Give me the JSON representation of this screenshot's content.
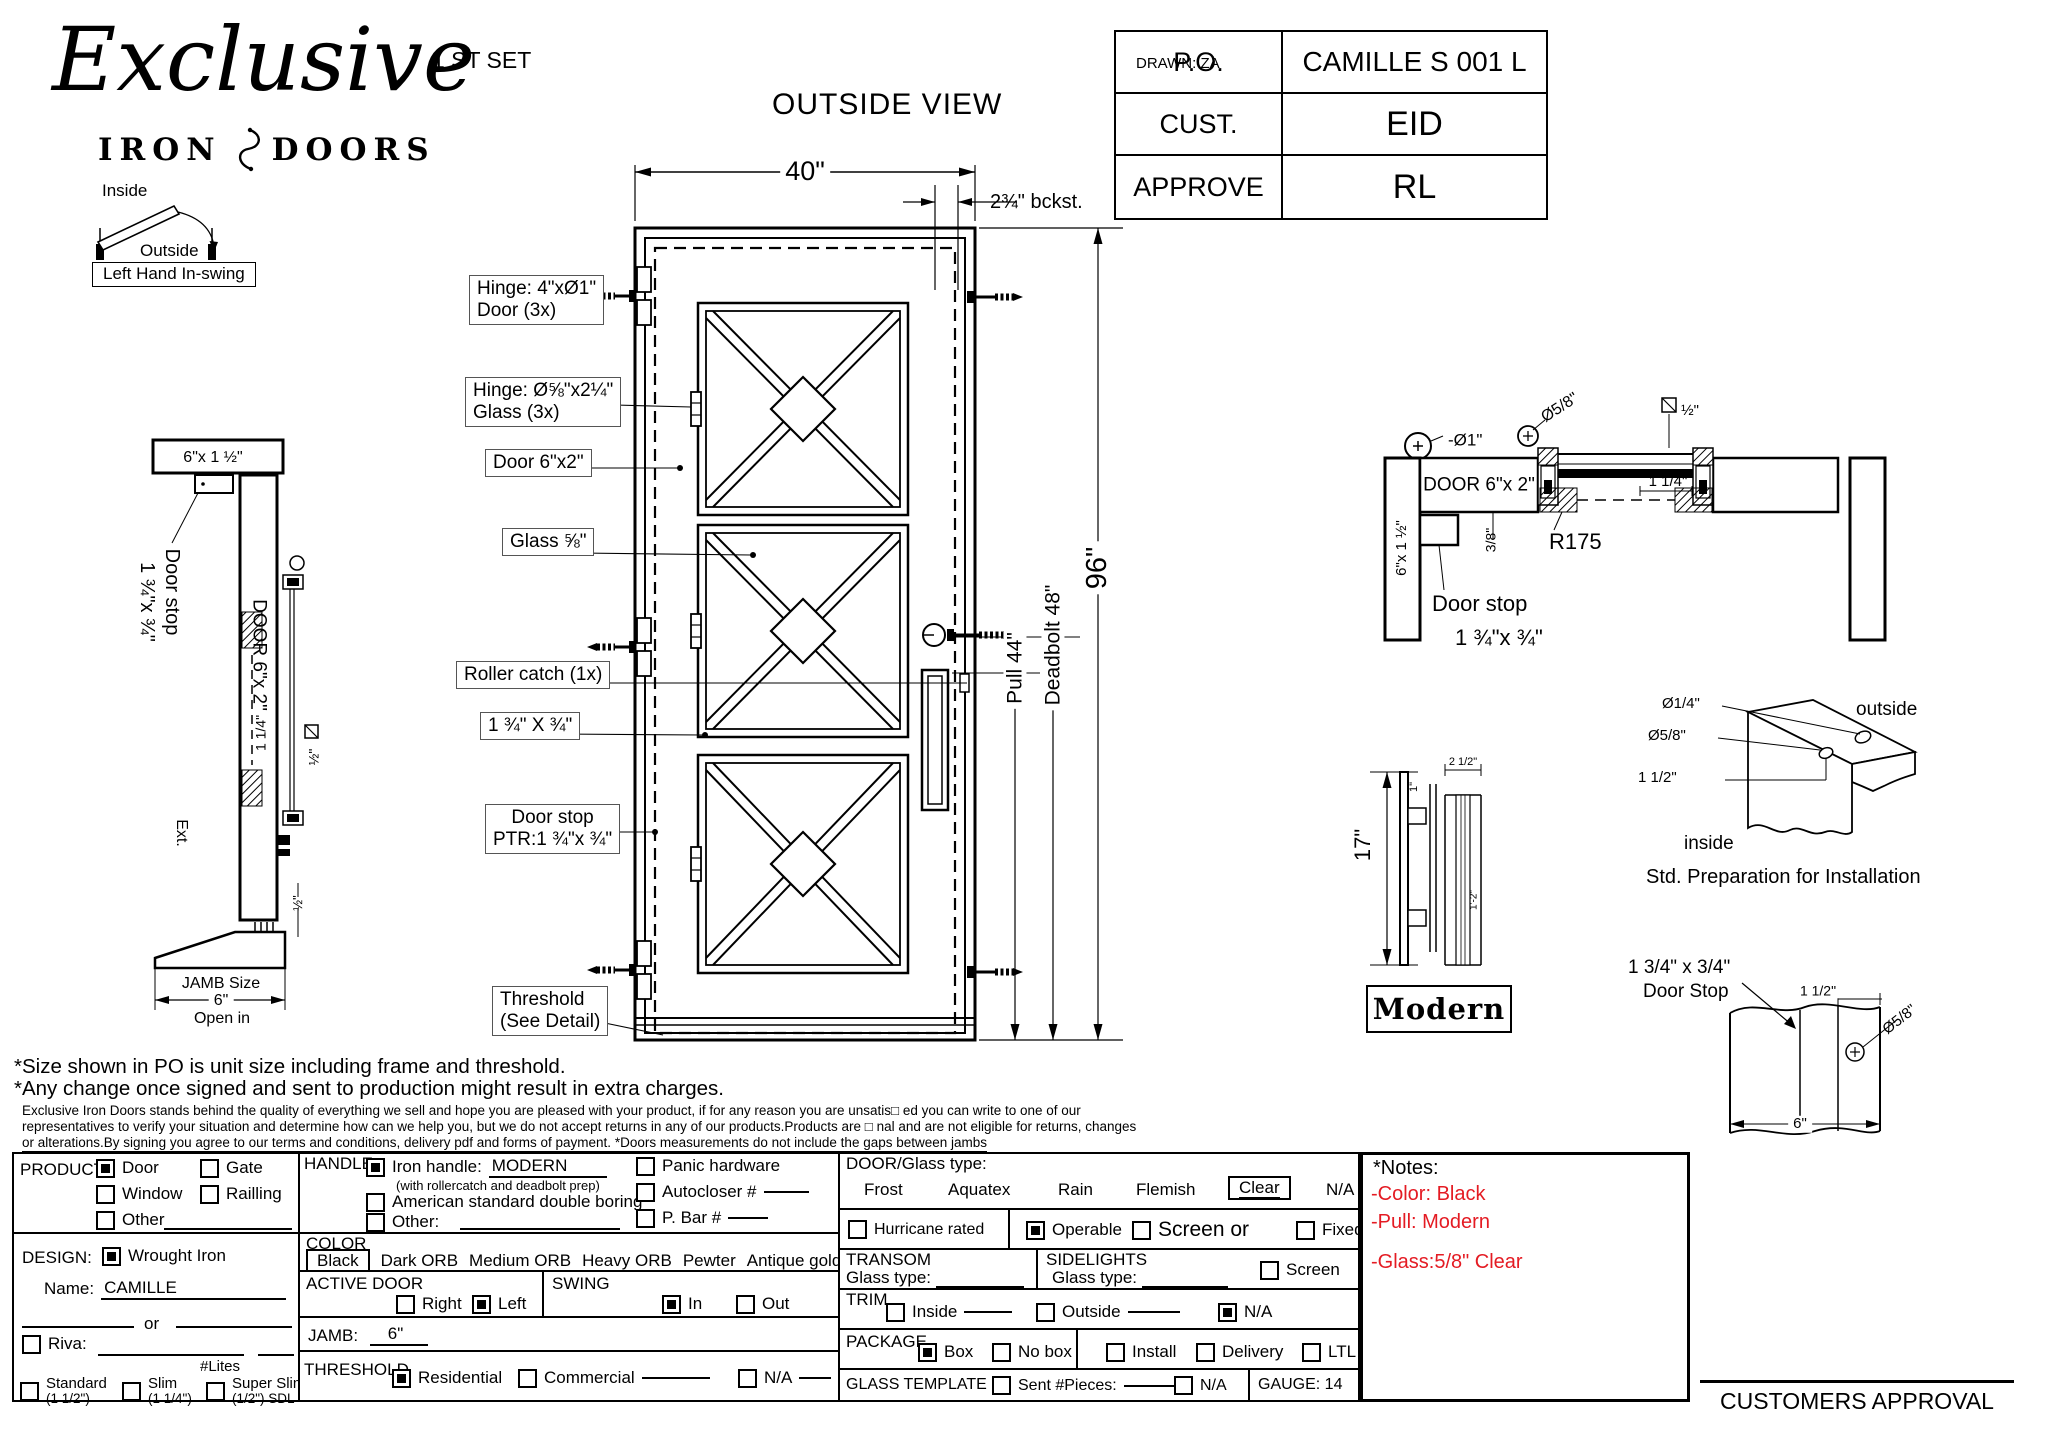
{
  "header": {
    "logo_script": "Exclusive",
    "logo_iron": "IRON",
    "logo_doors": "DOORS",
    "set_label": "1 ST SET",
    "view_title": "OUTSIDE VIEW",
    "drawn": "DRAWN: ZA"
  },
  "title_block": {
    "po_label": "P.O.",
    "po_value": "CAMILLE S 001 L",
    "cust_label": "CUST.",
    "cust_value": "EID",
    "approve_label": "APPROVE",
    "approve_value": "RL"
  },
  "swing_diagram": {
    "inside": "Inside",
    "outside": "Outside",
    "caption": "Left Hand In-swing"
  },
  "left_section": {
    "top_jamb": "6\"x 1 ½\"",
    "door_stop_line1": "Door stop",
    "door_stop_line2": "1 ¾\"x ¾\"",
    "door_vertical": "DOOR 6\"x 2\"",
    "reveal": "1 1/4\"",
    "glass_half": "½\"",
    "ext": "Ext.",
    "bottom_half": "½\"",
    "jamb_size_label": "JAMB Size",
    "jamb_size_value": "6\"",
    "open_in": "Open in"
  },
  "door_drawing": {
    "width_dim": "40\"",
    "backset_dim": "2¾\" bckst.",
    "height_dim": "96\"",
    "pull_dim": "Pull 44\"",
    "deadbolt_dim": "Deadbolt 48\"",
    "hinge_door_1": "Hinge: 4\"xØ1\"",
    "hinge_door_2": "Door (3x)",
    "hinge_glass_1": "Hinge: Ø⅝\"x2¼\"",
    "hinge_glass_2": "Glass (3x)",
    "door_frame": "Door 6\"x2\"",
    "glass": "Glass ⅝\"",
    "roller_catch": "Roller catch (1x)",
    "crossbar": "1 ¾\" X ¾\"",
    "door_stop_1": "Door stop",
    "door_stop_2": "PTR:1 ¾\"x ¾\"",
    "threshold_1": "Threshold",
    "threshold_2": "(See Detail)"
  },
  "right_section": {
    "hinge_dia": "-Ø1\"",
    "jamb_vertical": "6\"x 1 ½\"",
    "door_label": "DOOR 6\"x 2\"",
    "glass_hinge_dia": "Ø5/8\"",
    "glass_half": "½\"",
    "reveal": "1 1/4\"",
    "radius": "R175",
    "gap": "3/8\"",
    "door_stop_1": "Door stop",
    "door_stop_2": "1 ¾\"x ¾\""
  },
  "handle_detail": {
    "height": "17\"",
    "side_width": "1\"",
    "top_width": "2 1/2\"",
    "inner_height": "1'-2\"",
    "name": "Modern"
  },
  "install_detail": {
    "hole_small": "Ø1/4\"",
    "hole_large": "Ø5/8\"",
    "offset": "1 1/2\"",
    "outside": "outside",
    "inside": "inside",
    "caption": "Std. Preparation for Installation"
  },
  "stop_detail": {
    "title1": "1 3/4\" x 3/4\"",
    "title2": "Door Stop",
    "dim_top": "1 1/2\"",
    "dia": "Ø5/8\"",
    "dim_bottom": "6\""
  },
  "disclaimer": {
    "line1": "*Size shown in PO is unit size including frame and threshold.",
    "line2": "*Any change once signed and sent to production might result in extra charges.",
    "line3": "Exclusive Iron Doors stands behind the quality of everything we sell and hope you are pleased with your product, if for any reason you are unsatis□ ed you can write to one of our",
    "line4": "representatives to verify your situation and determine how can we help you, but we do not accept returns in any of our products.Products are □ nal and are not eligible for returns, changes",
    "line5": "or alterations.By signing you agree to our terms and conditions, delivery pdf and forms of payment. *Doors measurements do not include the gaps between jambs"
  },
  "form": {
    "product": {
      "label": "PRODUCT:",
      "door": {
        "label": "Door",
        "checked": true
      },
      "gate": {
        "label": "Gate",
        "checked": false
      },
      "window": {
        "label": "Window",
        "checked": false
      },
      "railling": {
        "label": "Railling",
        "checked": false
      },
      "other": {
        "label": "Other",
        "checked": false
      }
    },
    "design": {
      "label": "DESIGN:",
      "wrought": {
        "label": "Wrought Iron",
        "checked": true
      },
      "name_label": "Name:",
      "name_value": "CAMILLE",
      "or": "or",
      "riva": {
        "label": "Riva:",
        "checked": false
      },
      "lites": "#Lites",
      "standard": {
        "label": "Standard",
        "sub": "(1 1/2\")",
        "checked": false
      },
      "slim": {
        "label": "Slim",
        "sub": "(1 1/4\")",
        "checked": false
      },
      "superslim": {
        "label": "Super Slim",
        "sub": "(1/2\") SDL",
        "checked": false
      }
    },
    "handle": {
      "label": "HANDLE",
      "iron": {
        "label": "Iron handle:",
        "value": "MODERN",
        "note": "(with rollercatch and deadbolt prep)",
        "checked": true
      },
      "american": {
        "label": "American standard double boring",
        "checked": false
      },
      "other": {
        "label": "Other:",
        "checked": false
      },
      "panic": {
        "label": "Panic hardware",
        "checked": false
      },
      "autocloser": {
        "label": "Autocloser #",
        "checked": false
      },
      "pbar": {
        "label": "P. Bar #",
        "checked": false
      }
    },
    "color": {
      "label": "COLOR",
      "selected": "Black",
      "options": [
        "Dark ORB",
        "Medium ORB",
        "Heavy ORB",
        "Pewter",
        "Antique gold"
      ]
    },
    "active_door": {
      "label": "ACTIVE DOOR",
      "right": {
        "label": "Right",
        "checked": false
      },
      "left": {
        "label": "Left",
        "checked": true
      }
    },
    "swing": {
      "label": "SWING",
      "in_opt": {
        "label": "In",
        "checked": true
      },
      "out_opt": {
        "label": "Out",
        "checked": false
      }
    },
    "jamb": {
      "label": "JAMB:",
      "value": "6\""
    },
    "threshold": {
      "label": "THRESHOLD",
      "residential": {
        "label": "Residential",
        "checked": true
      },
      "commercial": {
        "label": "Commercial",
        "checked": false
      },
      "na": {
        "label": "N/A",
        "checked": false
      }
    },
    "door_glass": {
      "label": "DOOR/Glass type:",
      "opt_frost": "Frost",
      "opt_aquatex": "Aquatex",
      "opt_rain": "Rain",
      "opt_flemish": "Flemish",
      "selected": "Clear",
      "na": "N/A",
      "hurricane": {
        "label": "Hurricane rated",
        "checked": false
      },
      "operable": {
        "label": "Operable",
        "checked": true
      },
      "screen_or": {
        "label": "Screen or",
        "checked": false
      },
      "fixed": {
        "label": "Fixed",
        "checked": false
      }
    },
    "transom": {
      "label": "TRANSOM",
      "glass_type": "Glass type:"
    },
    "sidelights": {
      "label": "SIDELIGHTS",
      "glass_type": "Glass type:",
      "screen": {
        "label": "Screen",
        "checked": false
      }
    },
    "trim": {
      "label": "TRIM",
      "inside": {
        "label": "Inside",
        "checked": false
      },
      "outside": {
        "label": "Outside",
        "checked": false
      },
      "na": {
        "label": "N/A",
        "checked": true
      }
    },
    "package": {
      "label": "PACKAGE",
      "box": {
        "label": "Box",
        "checked": true
      },
      "nobox": {
        "label": "No box",
        "checked": false
      },
      "install": {
        "label": "Install",
        "checked": false
      },
      "delivery": {
        "label": "Delivery",
        "checked": false
      },
      "ltl": {
        "label": "LTL",
        "checked": false
      }
    },
    "glass_template": {
      "label": "GLASS TEMPLATE",
      "sent": {
        "label": "Sent #Pieces:",
        "checked": false
      },
      "na": {
        "label": "N/A",
        "checked": false
      }
    },
    "gauge": "GAUGE: 14"
  },
  "notes": {
    "title": "*Notes:",
    "color_note": "-Color: Black",
    "pull_note": "-Pull: Modern",
    "glass_note": "-Glass:5/8\"  Clear",
    "red": "#e41b23"
  },
  "approval": "CUSTOMERS APPROVAL"
}
